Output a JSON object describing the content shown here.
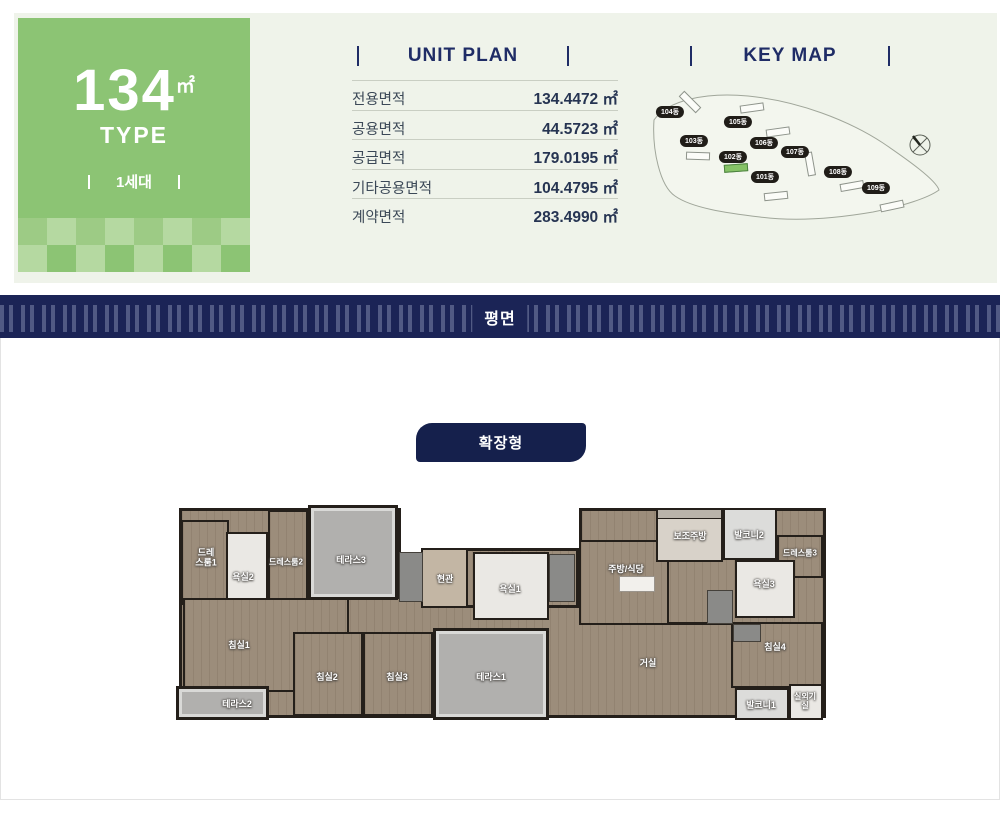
{
  "type_card": {
    "size": "134",
    "unit": "㎡",
    "type_word": "TYPE",
    "household": "1세대"
  },
  "unit_plan": {
    "title": "UNIT PLAN",
    "rows": [
      {
        "label": "전용면적",
        "value": "134.4472 ㎡"
      },
      {
        "label": "공용면적",
        "value": "44.5723 ㎡"
      },
      {
        "label": "공급면적",
        "value": "179.0195 ㎡"
      },
      {
        "label": "기타공용면적",
        "value": "104.4795 ㎡"
      },
      {
        "label": "계약면적",
        "value": "283.4990 ㎡"
      }
    ]
  },
  "key_map": {
    "title": "KEY MAP",
    "highlighted_building": "102동",
    "buildings": [
      {
        "label": "104동"
      },
      {
        "label": "105동"
      },
      {
        "label": "103동"
      },
      {
        "label": "106동"
      },
      {
        "label": "102동"
      },
      {
        "label": "107동"
      },
      {
        "label": "101동"
      },
      {
        "label": "108동"
      },
      {
        "label": "109동"
      }
    ]
  },
  "plan_area": {
    "banner_title": "평면",
    "plan_type_button": "확장형"
  },
  "floorplan": {
    "rooms": [
      {
        "label": "드레스룸1"
      },
      {
        "label": "욕실2"
      },
      {
        "label": "드레스룸2"
      },
      {
        "label": "테라스3"
      },
      {
        "label": "현관"
      },
      {
        "label": "욕실1"
      },
      {
        "label": "주방/식당"
      },
      {
        "label": "보조주방"
      },
      {
        "label": "발코니2"
      },
      {
        "label": "드레스룸3"
      },
      {
        "label": "욕실3"
      },
      {
        "label": "침실1"
      },
      {
        "label": "테라스2"
      },
      {
        "label": "침실2"
      },
      {
        "label": "침실3"
      },
      {
        "label": "테라스1"
      },
      {
        "label": "거실"
      },
      {
        "label": "침실4"
      },
      {
        "label": "발코니1"
      },
      {
        "label": "실외기실"
      }
    ]
  },
  "colors": {
    "accent_green": "#8cc474",
    "navy": "#1b2456",
    "panel_bg": "#eff3ea",
    "wood": "#9c8d7b",
    "terrace_gray": "#b1b0ae"
  }
}
